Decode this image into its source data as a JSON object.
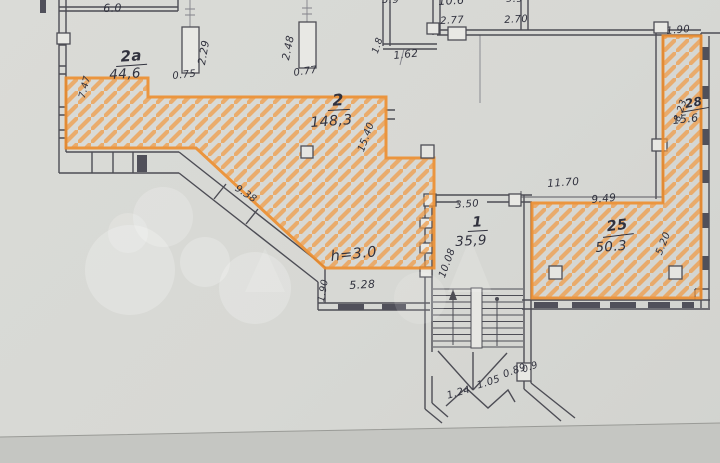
{
  "document_type": "floor-plan",
  "colors": {
    "highlight_orange": "#ee8e2e",
    "hatch_orange": "#f09a43",
    "ink": "#31323e",
    "wall": "#4d4d55",
    "paper": "#d9dad6",
    "paper_shadow": "#c5c6c2"
  },
  "rooms": [
    {
      "id": "2a",
      "number": "2a",
      "area": "44,6"
    },
    {
      "id": "2",
      "number": "2",
      "area": "148,3"
    },
    {
      "id": "1",
      "number": "1",
      "area": "35,9"
    },
    {
      "id": "25",
      "number": "25",
      "area": "50.3"
    },
    {
      "id": "28",
      "number": "28",
      "area": "15.6"
    }
  ],
  "ceiling_height": "h=3.0",
  "dimensions": {
    "top_left_width": "6.0",
    "left_height": "7.47",
    "col_a_len": "2.29",
    "col_a_w": "0.75",
    "col_b_len": "2.48",
    "col_b_w": "0.77",
    "niche_h": "1.8",
    "niche_w": "1.62",
    "room_top_1": "5.9",
    "room_top_2": "10.6",
    "room_top_3": "9.9",
    "w_277": "2.77",
    "w_270": "2.70",
    "strip_w": "1.90",
    "strip_h": "8.23",
    "big_room_h": "15.40",
    "diag_wall": "9.38",
    "vest_h": "1.90",
    "vest_w": "5.28",
    "stair_w": "3.50",
    "stair_h": "10.08",
    "top_1170": "11.70",
    "top_949": "9.49",
    "right_520": "5.20",
    "stair_1": "1.24",
    "stair_2": "1.05",
    "stair_3": "0.89",
    "stair_4": "0.9"
  }
}
